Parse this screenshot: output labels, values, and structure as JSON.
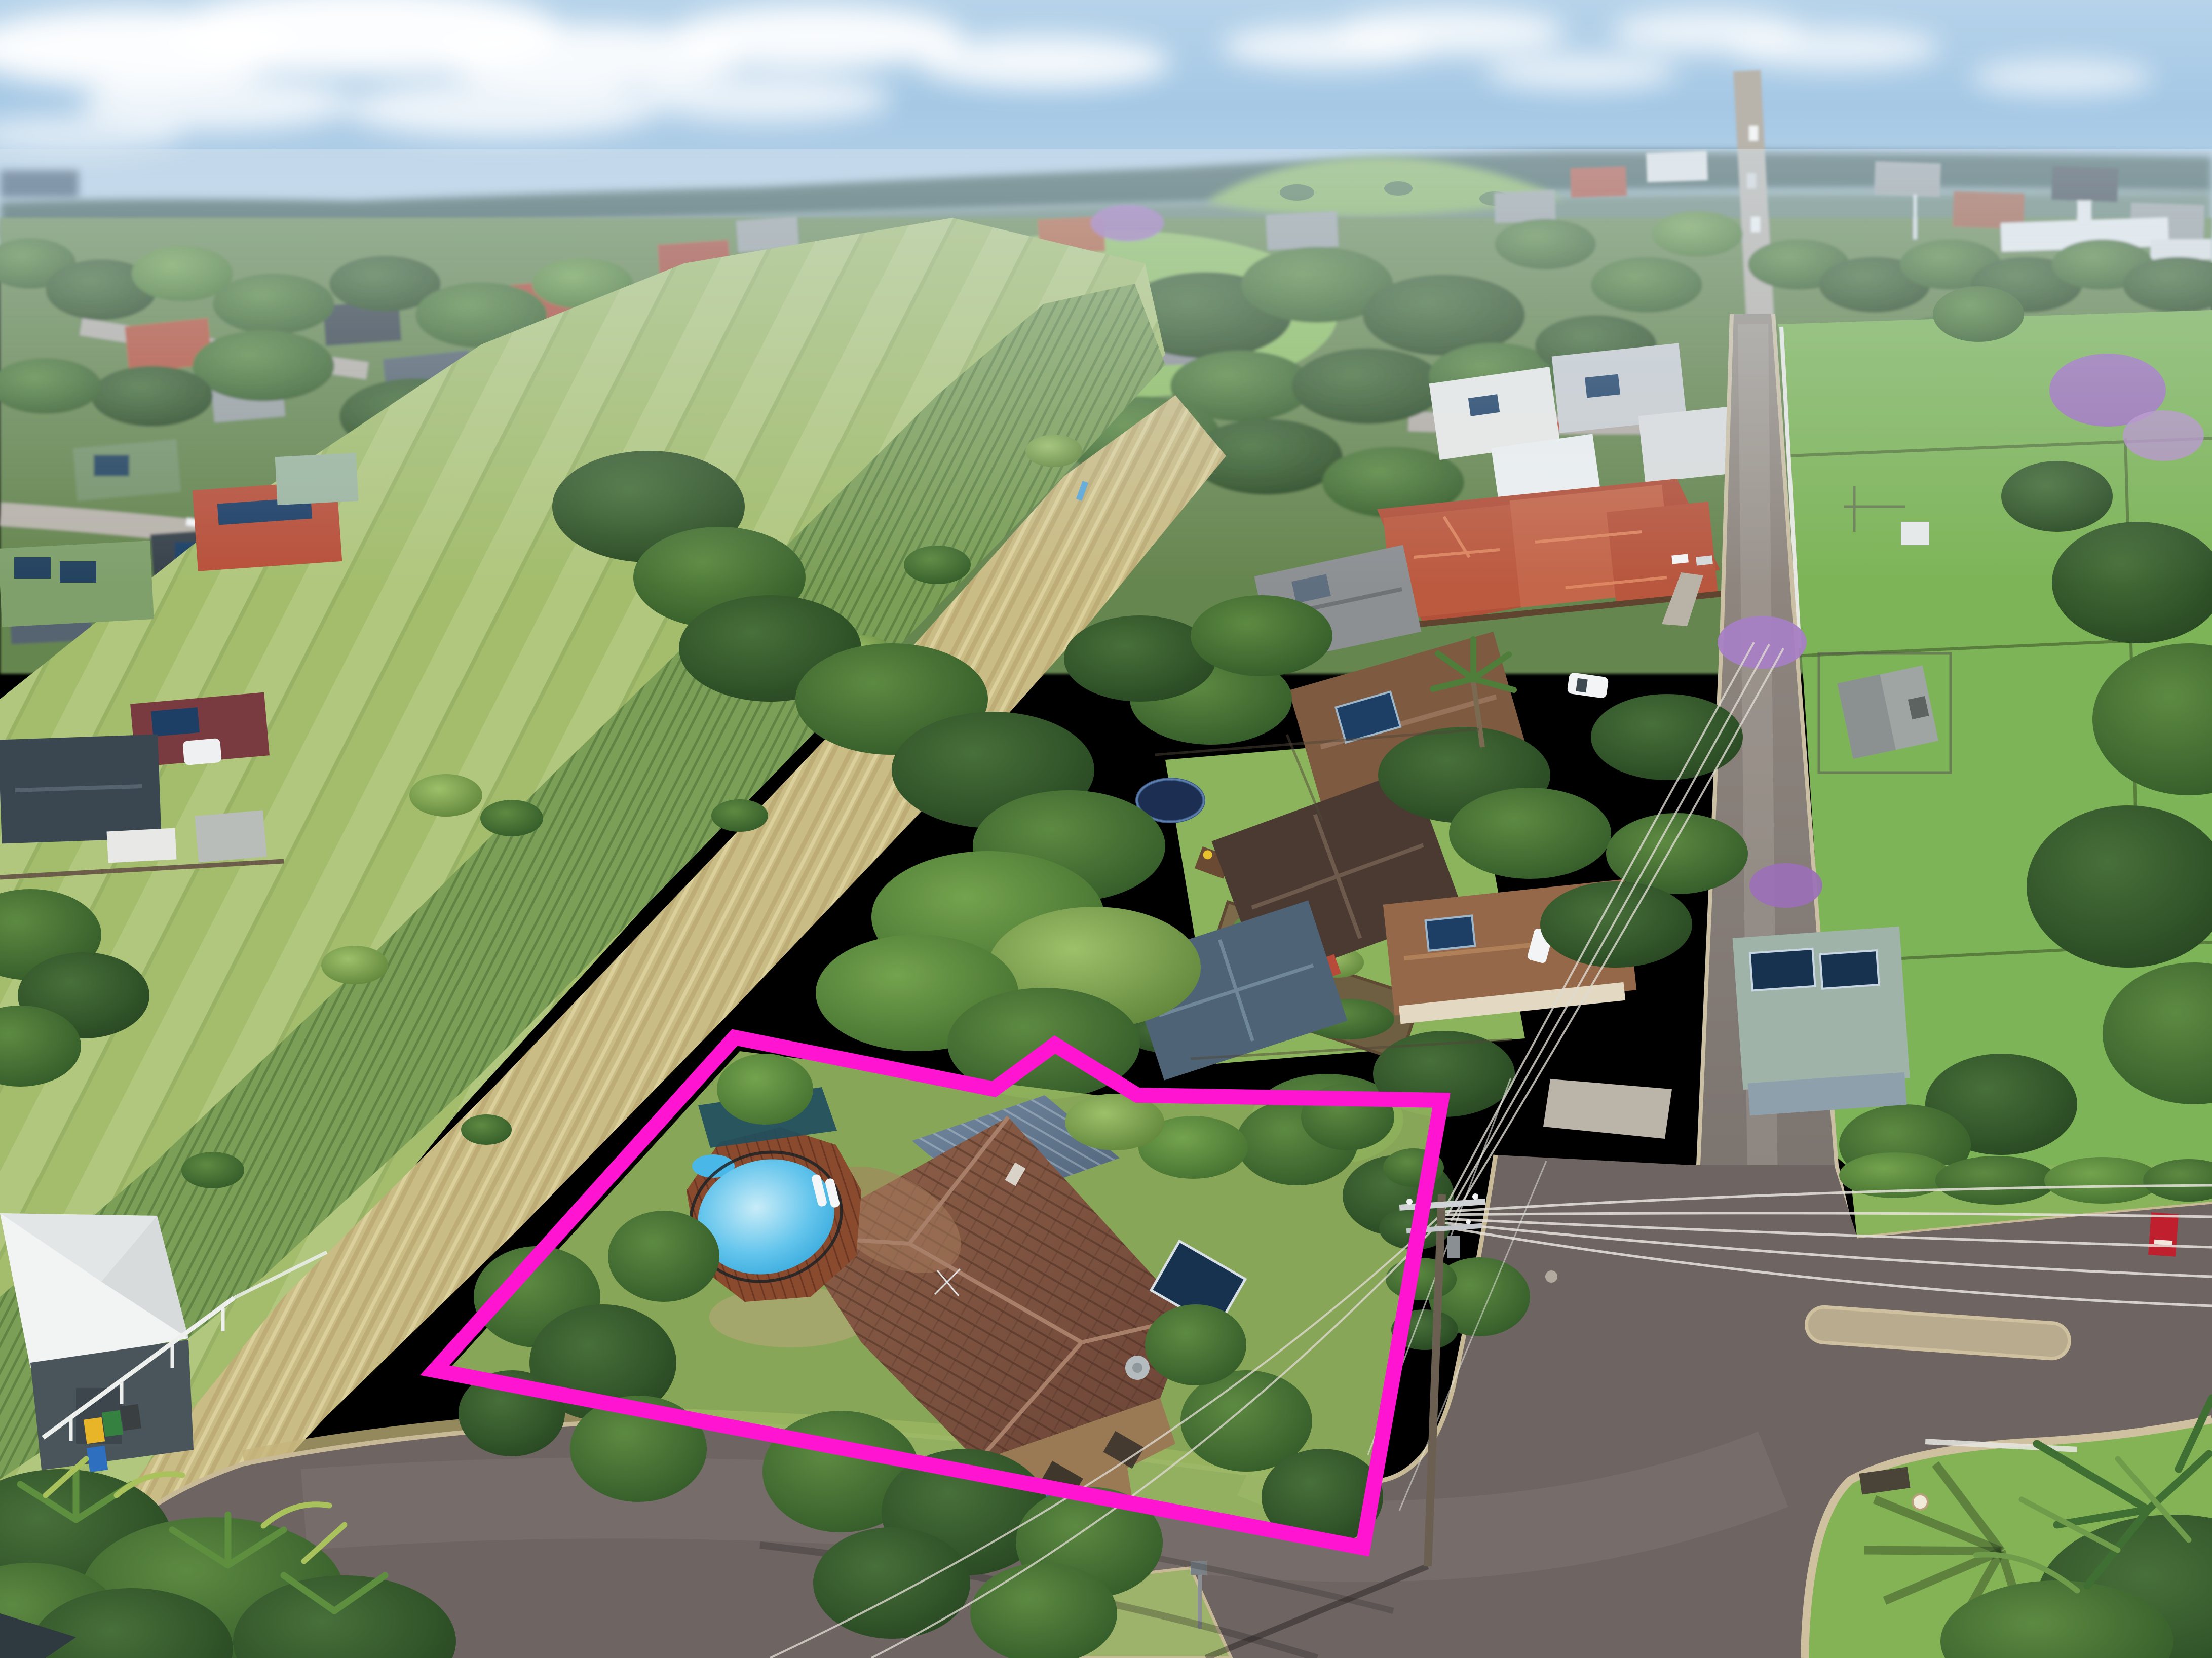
{
  "scene": {
    "type": "aerial-drone-photograph",
    "subject": "single residential property highlighted with a lot-boundary outline",
    "setting": "suburban town edge with grassy drainage reserve, school oval, paddocks, tree-lined streets and a road junction",
    "weather": "sunny, scattered white clouds over a distant forested ridge"
  },
  "annotation": {
    "boundary_color": "#ff14d2",
    "boundary_stroke_width": 30,
    "boundary_points": "1450,2048 1962,2150 2082,2062 2245,2162 2845,2172 2690,3055 858,2705"
  },
  "palette": {
    "sky_top": "#bdd8ec",
    "sky_horizon": "#cfe0ee",
    "ridge": "#3a5a58",
    "ocean_glimpse": "#2e4a62",
    "distant_hill": "#86b45c",
    "field_green": "#a3bd6d",
    "tall_grass": "#7c9f58",
    "dry_grass": "#cabc85",
    "paddock": "#7db457",
    "school_oval": "#8fbf63",
    "asphalt": "#6e6563",
    "curb": "#c9ba97",
    "pool_water": "#45b7e6",
    "pool_deck": "#8a4a2e",
    "subject_roof": "#7a5140",
    "metal_roof": "#5d7486",
    "terracotta_roof": "#b4543a",
    "charcoal_roof": "#323d46",
    "solar_panel": "#16324f",
    "jacaranda": "#9b6fb8",
    "for_sale_sign": "#c01f2e"
  }
}
